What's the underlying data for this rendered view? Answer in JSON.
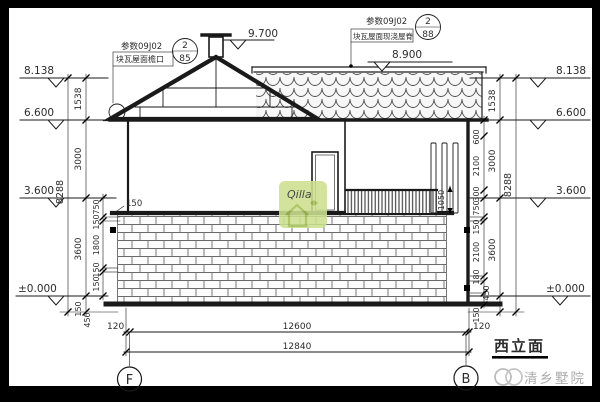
{
  "labels": {
    "title": "西立面",
    "brand": "清乡墅院",
    "logo_script": "Qilla",
    "axis_f": "F",
    "axis_b": "B"
  },
  "elevations": {
    "peak": "9.700",
    "parapet": "8.900",
    "l1": "8.138",
    "l2": "6.600",
    "l3": "3.600",
    "l4": "±0.000",
    "r1": "8.138",
    "r2": "6.600",
    "r3": "3.600",
    "r4": "±0.000"
  },
  "callouts": {
    "left": {
      "ref": "参数09J02",
      "num": "2",
      "page": "85",
      "label": "块瓦屋面檐口"
    },
    "right": {
      "ref": "参数09J02",
      "num": "2",
      "page": "88",
      "label": "块瓦屋面现浇屋脊"
    }
  },
  "dims": {
    "left": {
      "outer": "8288",
      "mid": [
        "1538",
        "3000",
        "3600"
      ],
      "inner": [
        "750",
        "150",
        "1800",
        "150",
        "150"
      ],
      "base": [
        "150",
        "450"
      ],
      "parapet": "150"
    },
    "right": {
      "outer": "8288",
      "mid": [
        "1538",
        "3000",
        "3600"
      ],
      "inner": [
        "600",
        "2100",
        "300",
        "750",
        "150",
        "2100",
        "180",
        "450"
      ],
      "base": "150",
      "railing": "1050"
    },
    "bottom": {
      "left_offset": "120",
      "span": "12600",
      "total": "12840",
      "right_offset": "120"
    }
  },
  "colors": {
    "line": "#1a1a1a",
    "logo_green": "#cde08f",
    "logo_stroke": "#a4c058",
    "watermark_gray": "#ababab"
  }
}
